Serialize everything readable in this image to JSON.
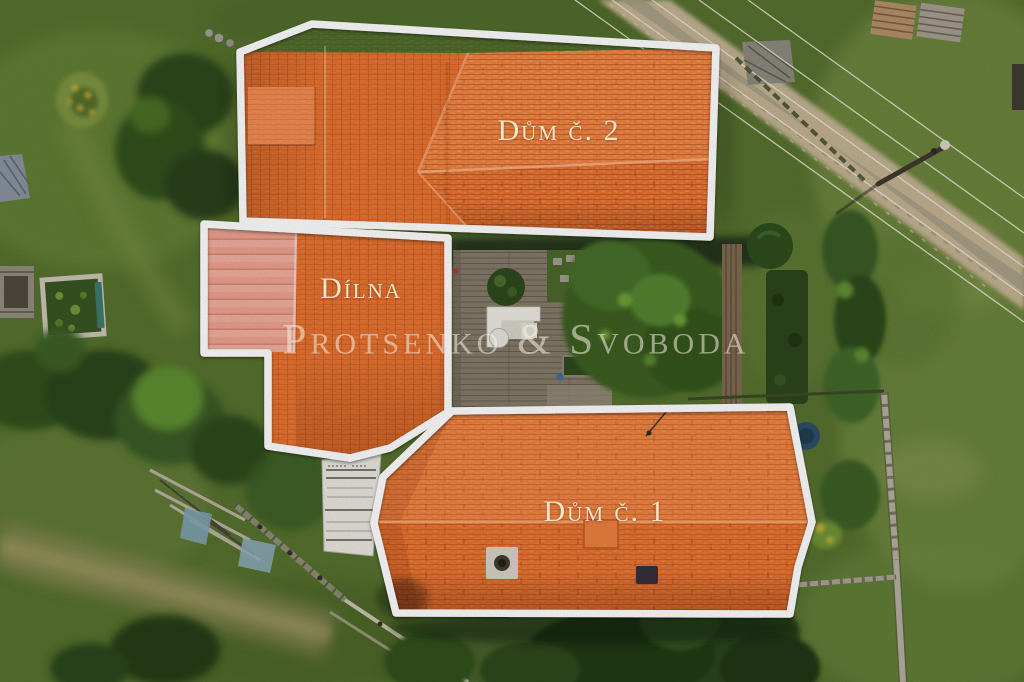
{
  "scene": {
    "type": "aerial-drone-photo",
    "description": "Top-down aerial photo of a rural property with three outlined orange-tile roofs, garden, lawn, dirt road and power lines",
    "width": 1024,
    "height": 682
  },
  "annotations": {
    "house2": {
      "label": "Dům č. 2"
    },
    "workshop": {
      "label": "Dílna"
    },
    "house1": {
      "label": "Dům č. 1"
    }
  },
  "watermark": {
    "text": "Protsenko & Svoboda"
  },
  "palette": {
    "roof-orange": "#E8722F",
    "roof-orange-light": "#F0823F",
    "roof-orange-dark": "#DD6428",
    "roof-pink": "#EFA28F",
    "roof-pink-light": "#F4B3A2",
    "outline-white": "#FFFFFF",
    "label-cream": "#F3E6C8",
    "watermark-cream": "rgba(247,239,224,0.55)",
    "grass-base": "#57722F",
    "grass-light": "#7C9549",
    "grass-dark": "#3F5A24",
    "tree-dark": "#2A421B",
    "tree-mid": "#3E6125",
    "tree-bright": "#5F8F33",
    "path-tan": "#C3B293",
    "deck-gray": "#857B6A",
    "wall-gray": "#B5AF9F",
    "fence-brown": "#7E6B50",
    "sheet-white": "#E9E7DE"
  }
}
